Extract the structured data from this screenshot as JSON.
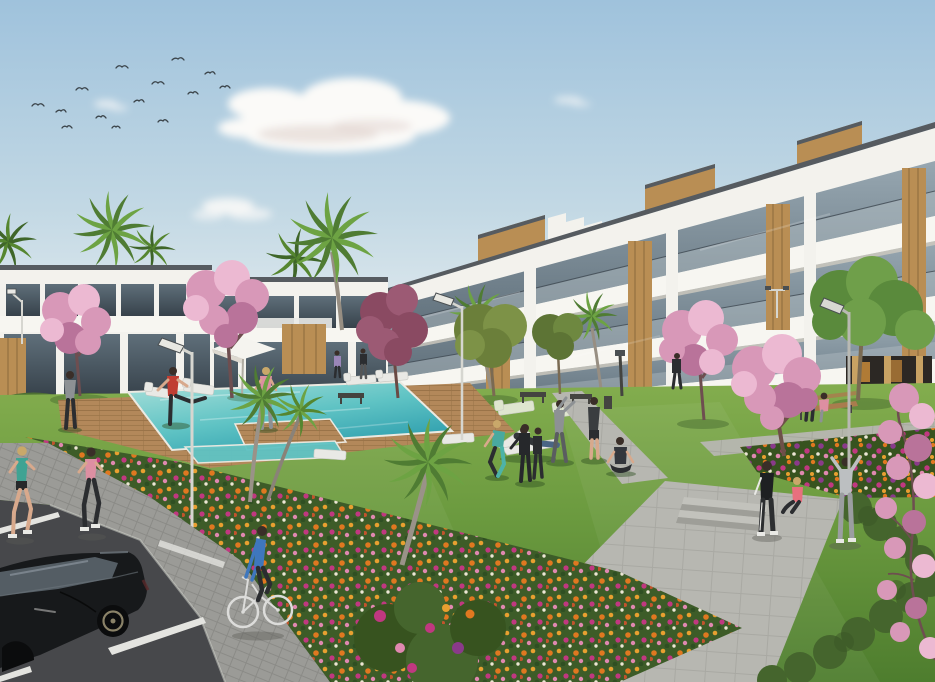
{
  "scene": {
    "type": "architectural-render",
    "description": "Photorealistic render of a modern white apartment complex with wood-panel accents, landscaped gardens, a turquoise swimming pool with wooden deck, residents exercising and jogging on the lawn, a cyclist on a paved path, a black car in the parking area, palm trees, pink cherry-blossom trees, flower beds and birds in a light blue sky",
    "setting": "new-build residential complex exterior",
    "time_of_day": "day"
  },
  "palette": {
    "sky_top": "#9fc2dc",
    "sky_mid": "#c2d8e4",
    "sky_horizon": "#e4ecef",
    "cloud_white": "#fbfaf8",
    "cloud_shadow": "#decfca",
    "bird": "#3c454b",
    "building_white": "#f3f2ed",
    "building_shade": "#e2dfd7",
    "band_white": "#f7f6f1",
    "band_shadow": "#cfcabf",
    "roof_dark": "#565b60",
    "glass_light": "#97a7b1",
    "glass_dark": "#5f6f7a",
    "glass_deep": "#37424b",
    "railing": "#b9c3c8",
    "rail_line": "#3d4750",
    "wood": "#b98e54",
    "wood_grain": "#8a6a3c",
    "column_tan": "#c8a263",
    "store_glow": "#c8893a",
    "store_dark": "#2c2824",
    "hedge": "#4d6f33",
    "hedge_dark": "#3a5526",
    "bush": "#45652d",
    "lawn_light": "#83ad4e",
    "lawn": "#6b9a3f",
    "lawn_deep": "#4e7d2e",
    "shade_green": "#2f4f22",
    "deck": "#b3885a",
    "deck_line": "#9a7348",
    "pool_far": "#a9e0da",
    "pool_mid": "#5fc3c4",
    "pool_near": "#2f9fae",
    "coping": "#eceae2",
    "path_conc": "#b7b7b1",
    "path_conc_line": "#a9a9a3",
    "paver": "#9b9b97",
    "paver_line": "#8b8b87",
    "asphalt": "#47484b",
    "stripe": "#e4e4e0",
    "flower_orange": "#e07820",
    "flower_gold": "#e8a030",
    "flower_magenta": "#c03880",
    "flower_pink": "#e088b0",
    "flower_white": "#ece6d4",
    "flower_purple": "#8a3a8a",
    "flower_red": "#c2542c",
    "bed_green": "#3d5c28",
    "bed_green2": "#37531f",
    "blossom_light": "#ecb9d2",
    "blossom": "#d898b8",
    "blossom_deep": "#b9739a",
    "branch": "#6e4e50",
    "leaf_purple": "#8a4a62",
    "leaf_purple2": "#9c5a74",
    "palm1": "#4f7c33",
    "palm2": "#6da343",
    "palm_dark1": "#3f6629",
    "palm_dark2": "#55862f",
    "trunk": "#978e82",
    "lamp_pole": "#d6d6d0",
    "lamp_dark": "#4a4f52",
    "bench_wood": "#a97c4e",
    "bench_dark": "#444440",
    "skin": "#d8a98c",
    "hair": "#3a2e28",
    "hair_blonde": "#c9a86a",
    "teal": "#3fa393",
    "pinkc": "#dd8fa2",
    "red": "#c03d32",
    "blue": "#3f77bd",
    "aqua": "#49a9a0",
    "darkc": "#2b2d30",
    "grayc": "#8d9194",
    "lgray": "#bcbfc1",
    "jeans": "#4a6584",
    "white_cloth": "#e9e9e5",
    "car_body": "#17191b",
    "car_body2": "#2e3236",
    "car_glass": "#545d64",
    "car_line": "#6d757c",
    "rim": "#8a8268",
    "bike": "#dcdcda"
  },
  "objects": {
    "buildings": [
      {
        "name": "left-apartment-block",
        "floors": 2,
        "style": "white flat-roof, dark glazing, wood accents"
      },
      {
        "name": "right-apartment-block",
        "floors": 3,
        "style": "white terraced balconies, glass balustrades, wood panels, rooftop penthouses"
      }
    ],
    "pool": {
      "water_color": "turquoise",
      "deck": "wood",
      "loungers": 8,
      "parasol": 1
    },
    "vehicles": [
      {
        "name": "black-hatchback-car"
      },
      {
        "name": "white-bicycle"
      }
    ],
    "people": [
      {
        "role": "jogger",
        "top_color": "teal"
      },
      {
        "role": "jogger",
        "top_color": "pink"
      },
      {
        "role": "walker",
        "top_color": "gray"
      },
      {
        "role": "stretching-person",
        "top_color": "red"
      },
      {
        "role": "walker",
        "top_color": "pink"
      },
      {
        "role": "walker-pair-near-building",
        "top_color": "lavender/dark"
      },
      {
        "role": "walker-near-building",
        "top_color": "dark"
      },
      {
        "role": "lounging-person-on-deck-chair",
        "top_color": "dark"
      },
      {
        "role": "stretching-woman",
        "top_color": "aqua"
      },
      {
        "role": "exercising-pair",
        "top_color": "black"
      },
      {
        "role": "stretching-man",
        "top_color": "gray"
      },
      {
        "role": "standing-man",
        "top_color": "dark"
      },
      {
        "role": "yoga-woman-seated",
        "top_color": "dark"
      },
      {
        "role": "standing-woman-on-path",
        "top_color": "black"
      },
      {
        "role": "sitting-woman-on-step",
        "top_color": "pink"
      },
      {
        "role": "stretching-person-arms-up",
        "top_color": "light gray"
      },
      {
        "role": "couple-on-bench",
        "top_color": "blue and pink"
      },
      {
        "role": "cyclist",
        "top_color": "blue"
      }
    ],
    "trees": {
      "palms": 9,
      "pink_blossom": 5,
      "purple_leaf": 1,
      "green_deciduous": 3
    },
    "street_lamps": 6,
    "benches": 4,
    "birds": 14,
    "flower_colors": [
      "orange",
      "gold",
      "magenta",
      "pink",
      "white",
      "purple",
      "red"
    ]
  }
}
